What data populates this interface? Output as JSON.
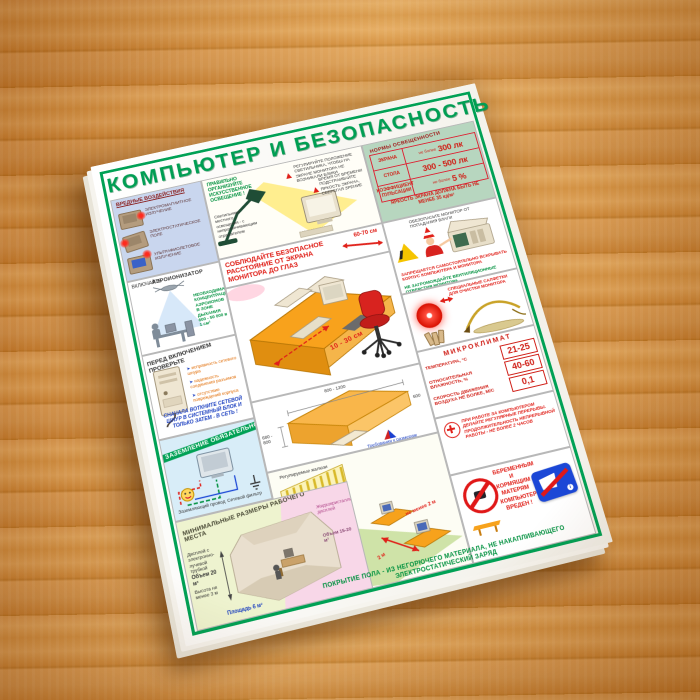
{
  "poster": {
    "title": "КОМПЬЮТЕР И БЕЗОПАСНОСТЬ",
    "colors": {
      "green": "#00a155",
      "red": "#e02019",
      "orange": "#f7a21c",
      "wood": "#dd9c52"
    },
    "norms": {
      "header": "НОРМЫ ОСВЕЩЕННОСТИ",
      "rows": [
        {
          "label": "ЭКРАНА",
          "qual": "не более",
          "value": "300 лк"
        },
        {
          "label": "СТОЛА",
          "qual": "",
          "value": "300 - 500 лк"
        },
        {
          "label": "КОЭФФИЦИЕНТ ПУЛЬСАЦИИ",
          "qual": "не более",
          "value": "5 %"
        }
      ],
      "footer": "ЯРКОСТЬ ЭКРАНА ДОЛЖНА БЫТЬ НЕ МЕНЕЕ 35 кд/м²"
    },
    "harmful": {
      "heading": "ВРЕДНЫЕ ВОЗДЕЙСТВИЯ",
      "items": [
        "ЭЛЕКТРОМАГНИТНОЕ ИЗЛУЧЕНИЕ",
        "ЭЛЕКТРОСТАТИЧЕСКОЕ ПОЛЕ",
        "УЛЬТРАФИОЛЕТОВОЕ ИЗЛУЧЕНИЕ"
      ]
    },
    "lighting": {
      "heading": "ПРАВИЛЬНО ОРГАНИЗУЙТЕ ИСКУССТВЕННОЕ ОСВЕЩЕНИЕ !",
      "note_left": "Светильники местного освещения - с непросвечивающим отражателем",
      "note_mid": "РЕГУЛИРУЙТЕ ПОЛОЖЕНИЕ СВЕТИЛЬНИКА, ЧТОБЫ НА ЭКРАНЕ МОНИТОРА НЕ ВОЗНИКАЛИ БЛИКИ",
      "note_right": "ВРЕМЯ ОТ ВРЕМЕНИ ПОДСТРАИВАЙТЕ ЯРКОСТЬ ЭКРАНА, СБЕРЕГАЯ ЗРЕНИЕ"
    },
    "ionizer": {
      "action": "ВКЛЮЧАЙТЕ",
      "device": "АЭРОИОНИЗАТОР",
      "note": "НЕОБХОДИМАЯ КОНЦЕНТРАЦИЯ АЭРОИОНОВ В ЗОНЕ ДЫХАНИЯ 600 - 50 000 в 1 см³"
    },
    "check": {
      "heading": "ПЕРЕД ВКЛЮЧЕНИЕМ ПРОВЕРЬТЕ",
      "bullets": [
        "исправность сетевого шнура",
        "надежность соединения разъемов",
        "отсутствие повреждений корпуса"
      ],
      "note": "СНАЧАЛА ВОТКНИТЕ СЕТЕВОЙ ШНУР В СИСТЕМНЫЙ БЛОК И ТОЛЬКО ЗАТЕМ - В СЕТЬ !"
    },
    "grounding": {
      "heading": "ЗАЗЕМЛЕНИЕ ОБЯЗАТЕЛЬНО",
      "label1": "Заземляющий провод",
      "label2": "Сетевой фильтр"
    },
    "workplace": {
      "heading": "МИНИМАЛЬНЫЕ РАЗМЕРЫ РАБОЧЕГО МЕСТА",
      "crt": "Дисплей с электронно-лучевой трубкой",
      "volume_crt": "Объем 20 м³",
      "height": "Высота не менее 3 м",
      "area": "Площадь 6 м²",
      "lcd": "Жидкокристаллический дисплей",
      "volume_lcd": "Объем 15-20 м³"
    },
    "distance": {
      "heading": "СОБЛЮДАЙТЕ БЕЗОПАСНОЕ РАССТОЯНИЕ ОТ ЭКРАНА МОНИТОРА ДО ГЛАЗ",
      "eyes": "60-70 см",
      "keyboard": "10 - 30 см"
    },
    "desk_dims": {
      "top": "800 - 1200",
      "left": "680 - 800",
      "right": "600",
      "caption": "Требования к размерам рабочего стола, мм"
    },
    "blinds": {
      "caption": "Регулируемые жалюзи",
      "d1": "не менее 2 м",
      "d2": "2 м"
    },
    "monitor_care": {
      "note": "ОБЕЗОПАСЬТЕ МОНИТОР ОТ ПОПАДАНИЯ ВЛАГИ",
      "forbid": "ЗАПРЕЩАЕТСЯ САМОСТОЯТЕЛЬНО ВСКРЫВАТЬ КОРПУС КОМПЬЮТЕРА И МОНИТОРА",
      "vents": "НЕ ЗАГРОМОЖДАЙТЕ ВЕНТИЛЯЦИОННЫЕ ОТВЕРСТИЯ МОНИТОРА"
    },
    "cleaning": {
      "label": "СПЕЦИАЛЬНЫЕ САЛФЕТКИ ДЛЯ ОЧИСТКИ МОНИТОРА"
    },
    "microclimate": {
      "header": "МИКРОКЛИМАТ",
      "rows": [
        {
          "label": "ТЕМПЕРАТУРА, °С",
          "value": "21-25"
        },
        {
          "label": "ОТНОСИТЕЛЬНАЯ ВЛАЖНОСТЬ, %",
          "value": "40-60"
        },
        {
          "label": "СКОРОСТЬ ДВИЖЕНИЯ ВОЗДУХА не более, м/с",
          "value": "0,1"
        }
      ]
    },
    "breaks": {
      "text": "ПРИ РАБОТЕ ЗА КОМПЬЮТЕРОМ ДЕЛАЙТЕ РЕГУЛЯРНЫЕ ПЕРЕРЫВЫ. ПРОДОЛЖИТЕЛЬНОСТЬ НЕПРЕРЫВНОЙ РАБОТЫ - НЕ БОЛЕЕ 2 ЧАСОВ"
    },
    "pregnancy": "БЕРЕМЕННЫМ И КОРМЯЩИМ МАТЕРЯМ КОМПЬЮТЕР ВРЕДЕН !",
    "floor_note": "ПОКРЫТИЕ ПОЛА - ИЗ НЕГОРЮЧЕГО МАТЕРИАЛА, НЕ НАКАПЛИВАЮЩЕГО ЭЛЕКТРОСТАТИЧЕСКИЙ ЗАРЯД"
  }
}
